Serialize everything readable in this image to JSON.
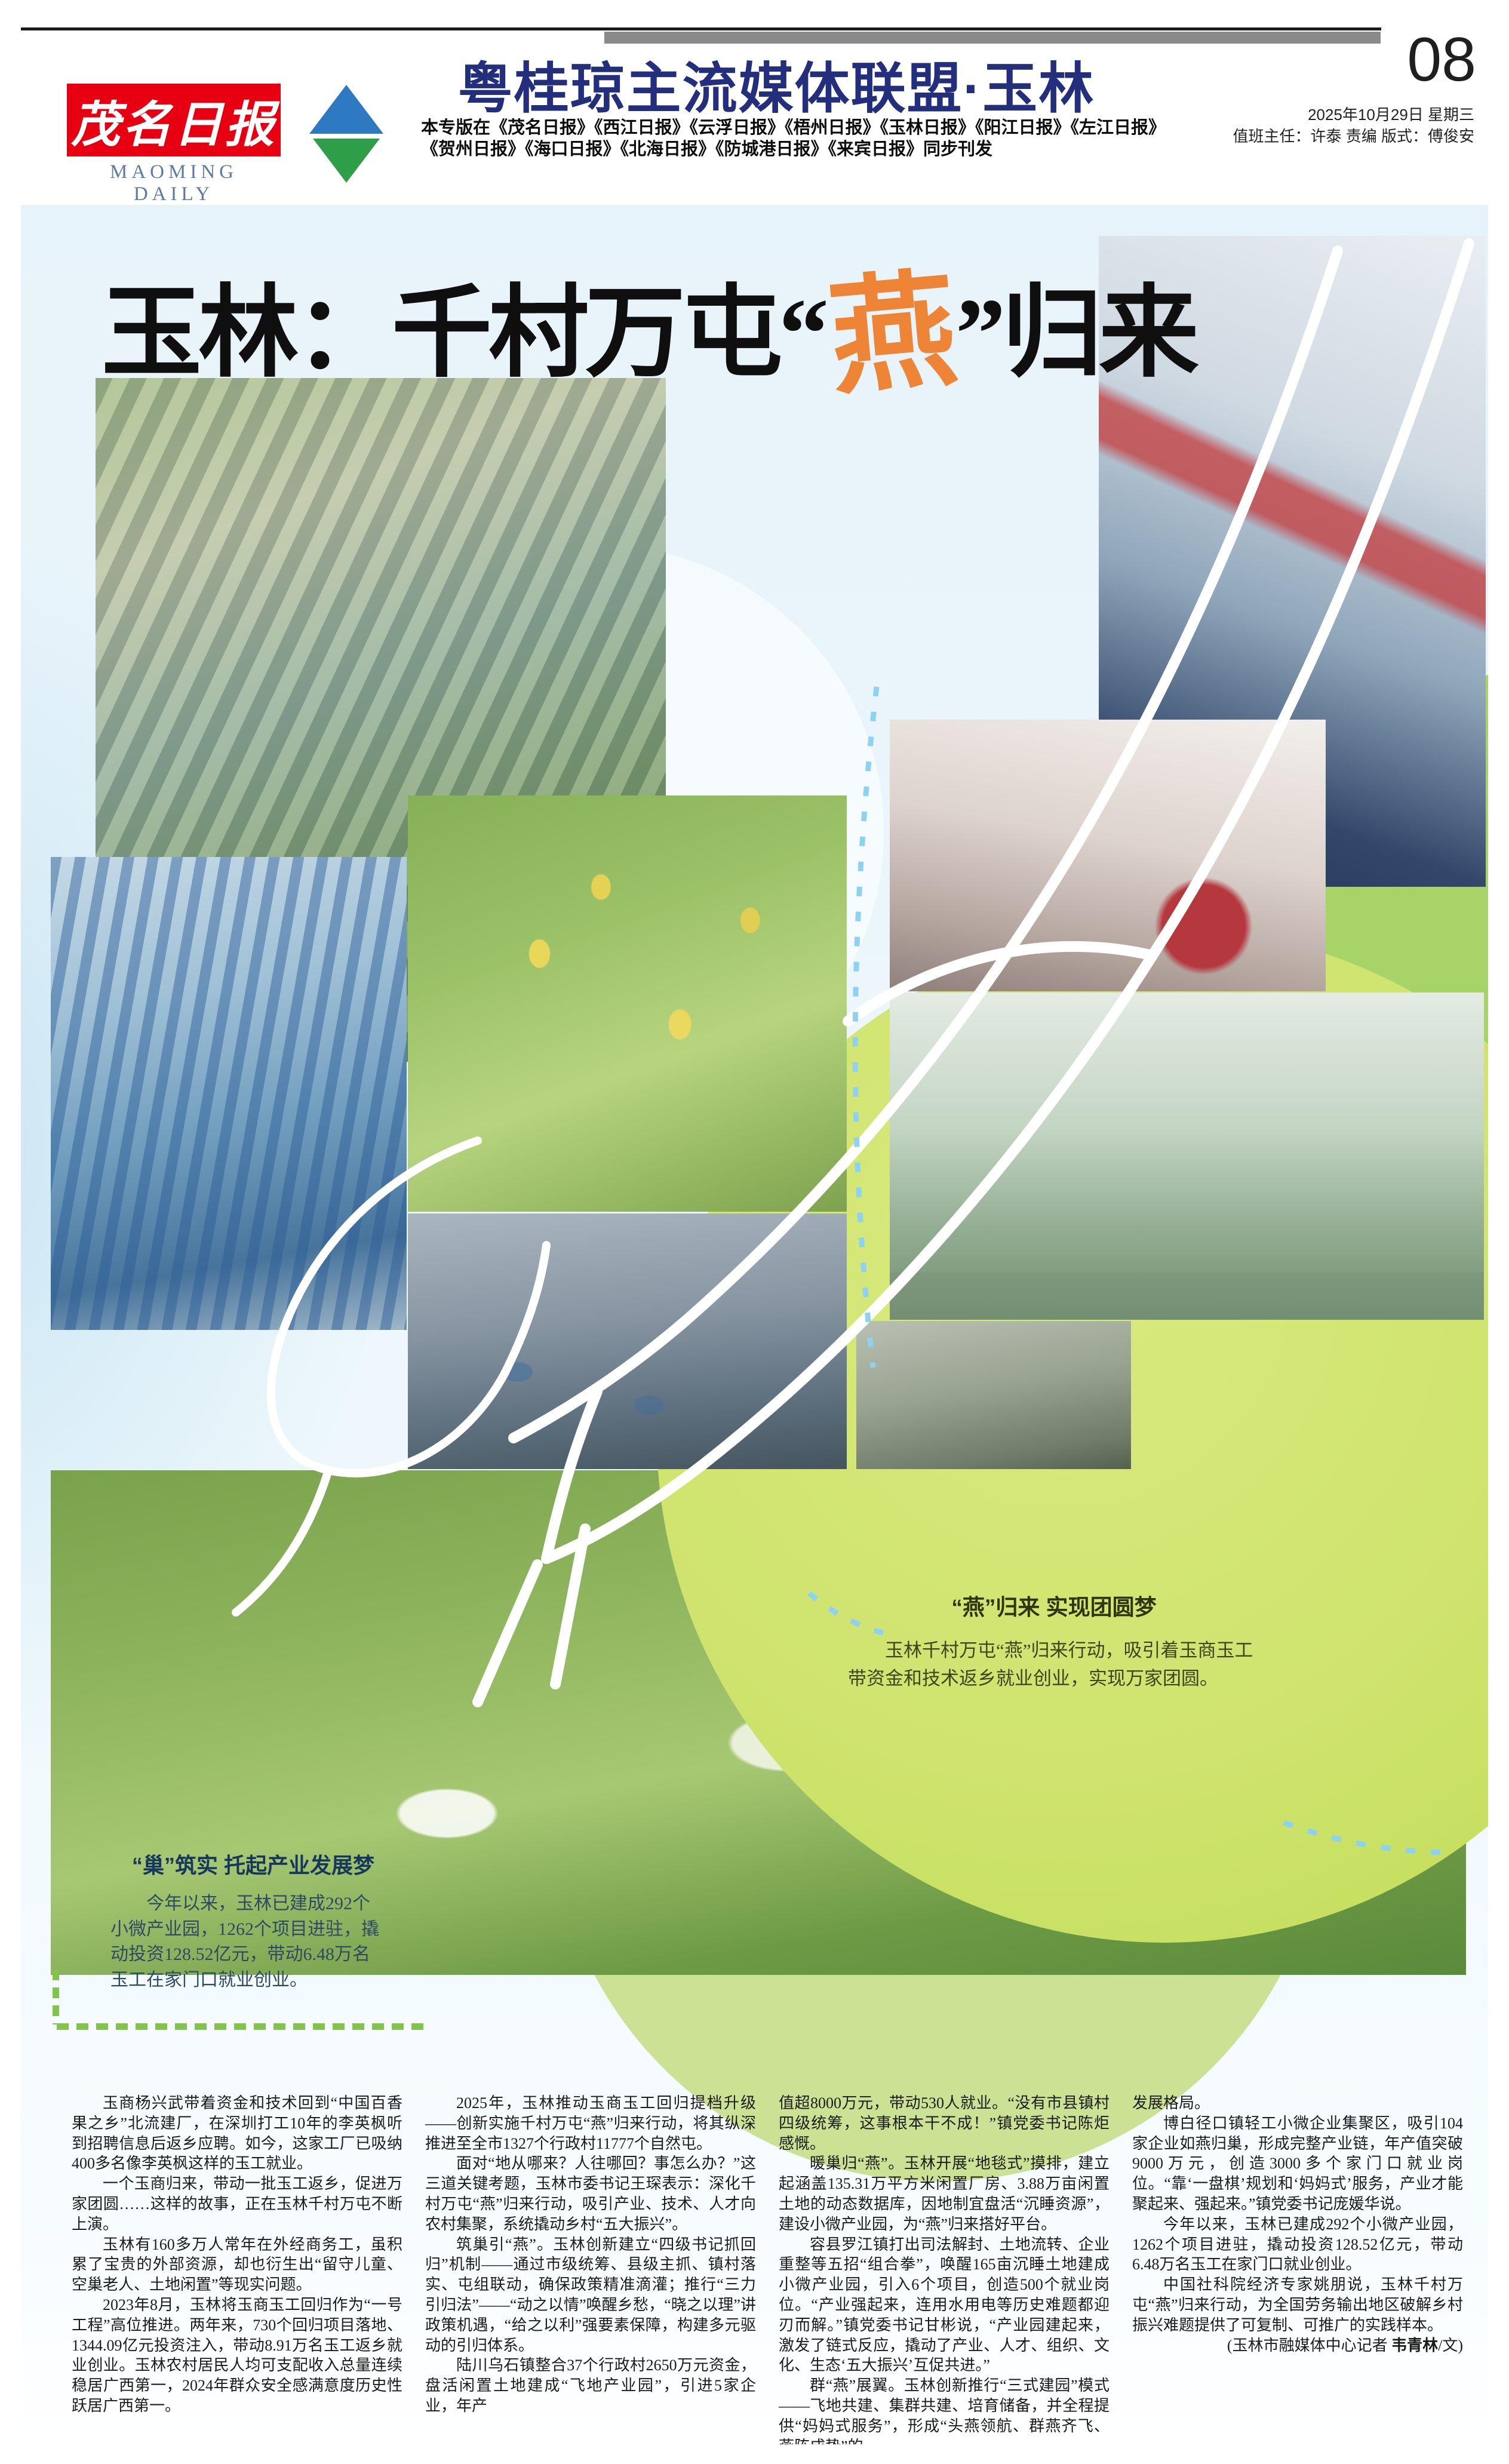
{
  "page": {
    "masthead": {
      "logo_cn": "茂名日报",
      "logo_en": "MAOMING DAILY"
    },
    "alliance_title": "粤桂琼主流媒体联盟·玉林",
    "edition_note_line1": "本专版在《茂名日报》《西江日报》《云浮日报》《梧州日报》《玉林日报》《阳江日报》《左江日报》",
    "edition_note_line2": "《贺州日报》《海口日报》《北海日报》《防城港日报》《来宾日报》同步刊发",
    "page_number": "08",
    "date_line": "2025年10月29日 星期三",
    "staff_line": "值班主任：许泰 责编 版式：傅俊安"
  },
  "headline": {
    "prefix": "玉林：千村万屯“",
    "accent": "燕",
    "suffix": "”归来"
  },
  "captions": {
    "swallow": {
      "title": "“燕”归来 实现团圆梦",
      "body": "玉林千村万屯“燕”归来行动，吸引着玉商玉工带资金和技术返乡就业创业，实现万家团圆。"
    },
    "nest": {
      "title": "“巢”筑实 托起产业发展梦",
      "body": "今年以来，玉林已建成292个小微产业园，1262个项目进驻，撬动投资128.52亿元，带动6.48万名玉工在家门口就业创业。"
    }
  },
  "photos": [
    {
      "name": "industrial-park-aerial-photo"
    },
    {
      "name": "sewing-worker-photo"
    },
    {
      "name": "knitting-factory-photo"
    },
    {
      "name": "electronics-workshop-photo"
    },
    {
      "name": "couple-passionfruit-photo"
    },
    {
      "name": "blue-roof-factories-aerial-photo"
    },
    {
      "name": "food-processing-photo"
    },
    {
      "name": "machine-operator-photo"
    },
    {
      "name": "villa-resort-aerial-photo"
    }
  ],
  "colors": {
    "navy": "#232e7d",
    "orange": "#ee8435",
    "lime": "#cfe36e",
    "red": "#e60012"
  },
  "article": {
    "columns": [
      {
        "paragraphs": [
          "玉商杨兴武带着资金和技术回到“中国百香果之乡”北流建厂，在深圳打工10年的李英枫听到招聘信息后返乡应聘。如今，这家工厂已吸纳400多名像李英枫这样的玉工就业。",
          "一个玉商归来，带动一批玉工返乡，促进万家团圆……这样的故事，正在玉林千村万屯不断上演。",
          "玉林有160多万人常年在外经商务工，虽积累了宝贵的外部资源，却也衍生出“留守儿童、空巢老人、土地闲置”等现实问题。",
          "2023年8月，玉林将玉商玉工回归作为“一号工程”高位推进。两年来，730个回归项目落地、1344.09亿元投资注入，带动8.91万名玉工返乡就业创业。玉林农村居民人均可支配收入总量连续稳居广西第一，2024年群众安全感满意度历史性跃居广西第一。"
        ]
      },
      {
        "paragraphs": [
          "2025年，玉林推动玉商玉工回归提档升级——创新实施千村万屯“燕”归来行动，将其纵深推进至全市1327个行政村11777个自然屯。",
          "面对“地从哪来？人往哪回？事怎么办？”这三道关键考题，玉林市委书记王琛表示：深化千村万屯“燕”归来行动，吸引产业、技术、人才向农村集聚，系统撬动乡村“五大振兴”。",
          "筑巢引“燕”。玉林创新建立“四级书记抓回归”机制——通过市级统筹、县级主抓、镇村落实、屯组联动，确保政策精准滴灌；推行“三力引归法”——“动之以情”唤醒乡愁，“晓之以理”讲政策机遇，“给之以利”强要素保障，构建多元驱动的引归体系。",
          "陆川乌石镇整合37个行政村2650万元资金，盘活闲置土地建成“飞地产业园”，引进5家企业，年产"
        ]
      },
      {
        "paragraphs": [
          "值超8000万元，带动530人就业。“没有市县镇村四级统筹，这事根本干不成！”镇党委书记陈炬感慨。",
          "暖巢归“燕”。玉林开展“地毯式”摸排，建立起涵盖135.31万平方米闲置厂房、3.88万亩闲置土地的动态数据库，因地制宜盘活“沉睡资源”，建设小微产业园，为“燕”归来搭好平台。",
          "容县罗江镇打出司法解封、土地流转、企业重整等五招“组合拳”，唤醒165亩沉睡土地建成小微产业园，引入6个项目，创造500个就业岗位。“产业强起来，连用水用电等历史难题都迎刃而解。”镇党委书记甘彬说，“产业园建起来，激发了链式反应，撬动了产业、人才、组织、文化、生态‘五大振兴’互促共进。”",
          "群“燕”展翼。玉林创新推行“三式建园”模式——飞地共建、集群共建、培育储备，并全程提供“妈妈式服务”，形成“头燕领航、群燕齐飞、燕阵成势”的"
        ]
      },
      {
        "paragraphs": [
          "发展格局。",
          "博白径口镇轻工小微企业集聚区，吸引104家企业如燕归巢，形成完整产业链，年产值突破9000万元，创造3000多个家门口就业岗位。“靠‘一盘棋’规划和‘妈妈式’服务，产业才能聚起来、强起来。”镇党委书记庞媛华说。",
          "今年以来，玉林已建成292个小微产业园，1262个项目进驻，撬动投资128.52亿元，带动6.48万名玉工在家门口就业创业。",
          "中国社科院经济专家姚朋说，玉林千村万屯“燕”归来行动，为全国劳务输出地区破解乡村振兴难题提供了可复制、可推广的实践样本。"
        ]
      }
    ],
    "byline_prefix": "(玉林市融媒体中心记者 ",
    "byline_name": "韦青林",
    "byline_suffix": "/文)"
  }
}
